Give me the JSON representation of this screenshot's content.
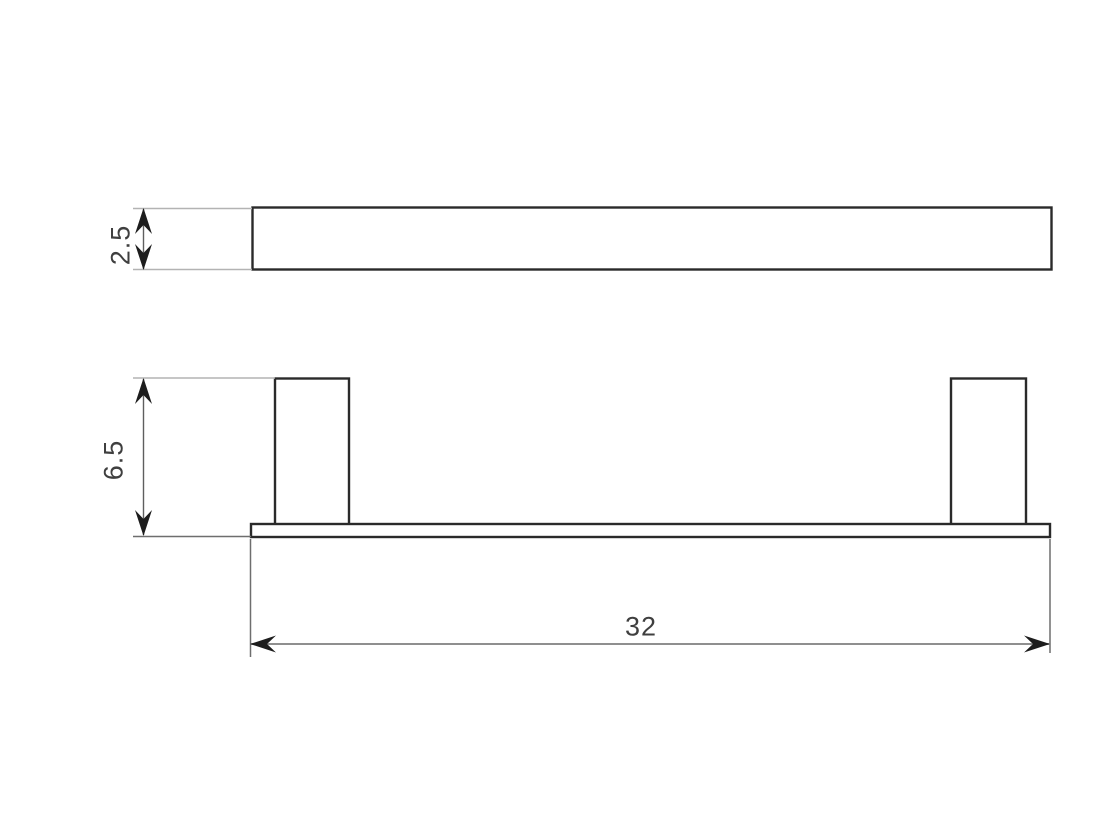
{
  "dimensions": {
    "profile_thickness": {
      "label": "2.5"
    },
    "overall_height": {
      "label": "6.5"
    },
    "overall_length": {
      "label": "32"
    }
  },
  "colors": {
    "background": "#ffffff",
    "outline": "#2a2a2a",
    "dimension-line": "#8f8f8f",
    "dimension-line-dark": "#5f5f5f",
    "extension-line": "#b3b3b3",
    "extension-line-dark": "#6e6e6e",
    "arrow": "#1d1d1d",
    "text": "#3f3f3f"
  }
}
